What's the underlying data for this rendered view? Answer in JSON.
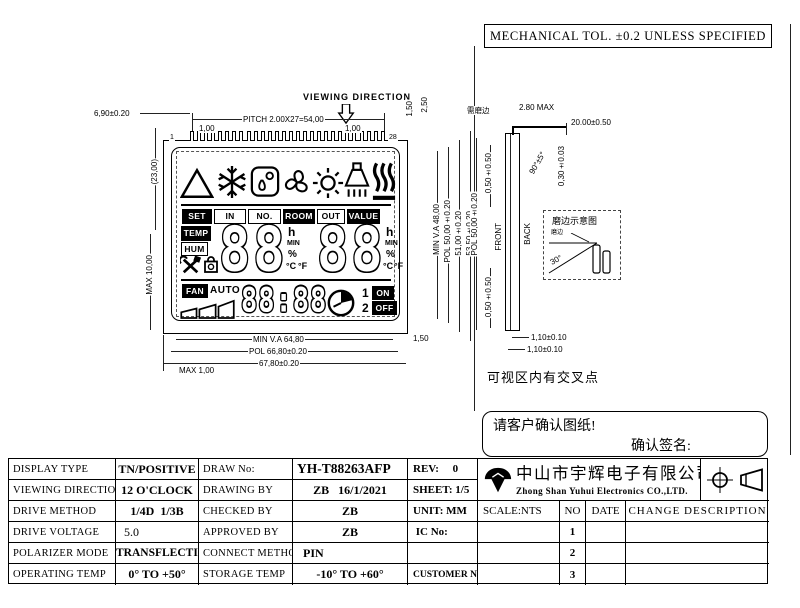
{
  "sheet": {
    "tol_note": "MECHANICAL TOL. ±0.2 UNLESS SPECIFIED"
  },
  "front_view": {
    "viewing_direction": "VIEWING DIRECTION",
    "pin_count": 28,
    "pin_first": "1",
    "pin_last": "28",
    "dims": {
      "lead": "6,90±0.20",
      "pitch": "PITCH 2.00X27=54,00",
      "gap_left": "1,00",
      "gap_right": "1,00",
      "top_t1": "1,50",
      "top_t2": "2,50",
      "left_h": "(23,00)",
      "left_max": "MAX 10,00",
      "right_va": "MIN V.A 48,00",
      "right_pol": "POL 50,00±0.20",
      "right_glass": "51,00±0.20",
      "right_total": "53,50±0.20",
      "right_bottom": "1,50",
      "bottom_va": "MIN V.A 64,80",
      "bottom_pol": "POL 66,80±0.20",
      "bottom_total": "67,80±0.20",
      "bottom_max": "MAX 1,00"
    },
    "lcd": {
      "labels": [
        "SET",
        "IN",
        "NO.",
        "ROOM",
        "OUT",
        "VALUE"
      ],
      "temp": "TEMP",
      "hum": "HUM",
      "digits1": "88",
      "digits2": "88",
      "unit_h": "h",
      "unit_min": "MIN",
      "unit_pct": "%",
      "unit_c": "°C",
      "unit_f": "°F",
      "fan": "FAN",
      "auto": "AUTO",
      "clock": "88:88",
      "n1": "1",
      "on": "ON",
      "n2": "2",
      "off": "OFF"
    }
  },
  "side_view": {
    "front": "FRONT",
    "back": "BACK",
    "grind": "需磨边",
    "dims": {
      "top_max": "2.80 MAX",
      "pin_len": "20.00±0.50",
      "angle": "90°±5°",
      "pin_th": "0,30±0.03",
      "top_off": "0,50±0.50",
      "pol": "POL 50,00±0.20",
      "bot_off": "0,50±0.50",
      "b1": "1,10±0.10",
      "b2": "1,10±0.10"
    }
  },
  "detail": {
    "title": "磨边示意图",
    "label": "磨边",
    "angle": "30°"
  },
  "notes": {
    "cross": "可视区内有交叉点",
    "confirm": "请客户确认图纸!",
    "sign": "确认签名:"
  },
  "title_block": {
    "left": [
      {
        "label": "DISPLAY TYPE",
        "value": "TN/POSITIVE"
      },
      {
        "label": "VIEWING DIRECTION",
        "value": "12 O'CLOCK"
      },
      {
        "label": "DRIVE METHOD",
        "value": "1/4D  1/3B"
      },
      {
        "label": "DRIVE VOLTAGE",
        "value": "5.0"
      },
      {
        "label": "POLARIZER MODE",
        "value": "TRANSFLECTIVE"
      },
      {
        "label": "OPERATING TEMP",
        "value": "0° TO +50°"
      }
    ],
    "mid": [
      {
        "label": "DRAW No:",
        "value": "YH-T88263AFP"
      },
      {
        "label": "DRAWING BY",
        "value": "ZB   16/1/2021"
      },
      {
        "label": "CHECKED BY",
        "value": "ZB"
      },
      {
        "label": "APPROVED BY",
        "value": "ZB"
      },
      {
        "label": "CONNECT METHOD",
        "value": "PIN"
      },
      {
        "label": "STORAGE TEMP",
        "value": "-10° TO +60°"
      }
    ],
    "info": [
      "REV:     0",
      "SHEET: 1/5",
      "UNIT: MM",
      " IC No:",
      "",
      "CUSTOMER No."
    ],
    "company_cn": "中山市宇辉电子有限公司",
    "company_en": "Zhong Shan Yuhui Electronics CO.,LTD.",
    "scale": "SCALE:NTS",
    "rev_headers": [
      "NO",
      "DATE",
      "CHANGE DESCRIPTION"
    ],
    "rev_rows": [
      "1",
      "2",
      "3"
    ]
  }
}
